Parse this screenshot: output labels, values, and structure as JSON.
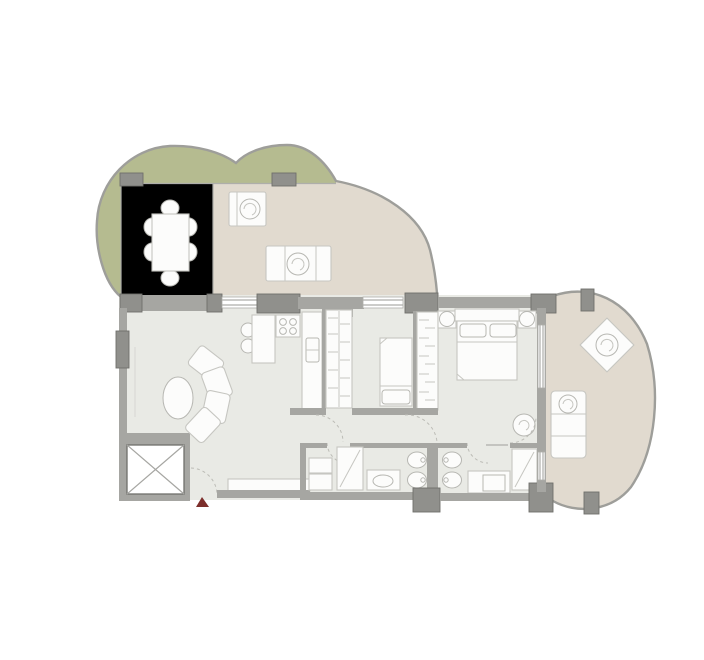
{
  "canvas": {
    "width": 704,
    "height": 660,
    "kind": "apartment-floor-plan"
  },
  "colors": {
    "background": "#ffffff",
    "floor": "#e9eae5",
    "dining_floor": "#ececе8",
    "terrace": "#e1dacf",
    "green": "#b5bb90",
    "wall": "#a6a6a2",
    "pillar": "#90908c",
    "pillar_stroke": "#6f6f6b",
    "outline": "#9e9e9a",
    "furniture": "#fcfcfb",
    "furniture_stroke": "#c6c6c1",
    "fixture_stroke": "#b7b7b2",
    "thin": "#d7d7d2",
    "glass": "#aeaeaa",
    "dash": "#bcbcb6",
    "hatch": "#c6c6c1",
    "red": "#7d2f2c"
  },
  "rooms": [
    {
      "name": "planted-border"
    },
    {
      "name": "dining-room"
    },
    {
      "name": "terrace"
    },
    {
      "name": "living-room"
    },
    {
      "name": "kitchen"
    },
    {
      "name": "hallway"
    },
    {
      "name": "bedroom-small"
    },
    {
      "name": "bedroom-master"
    },
    {
      "name": "bathroom-1"
    },
    {
      "name": "bathroom-2"
    },
    {
      "name": "balcony"
    },
    {
      "name": "elevator-shaft"
    }
  ],
  "furniture": [
    "dining-table-6-chairs",
    "terrace-armchair",
    "terrace-lounger",
    "breakfast-bar-2-stools",
    "curved-sofa",
    "oval-rug",
    "stove-4-burners",
    "kitchen-sink",
    "wardrobe-1",
    "wardrobe-2",
    "single-bed",
    "double-bed-2-nightstands",
    "plant",
    "washer-dryer",
    "shower-1",
    "sink-basin",
    "toilet-1",
    "bidet-1",
    "toilet-2",
    "bidet-2",
    "vanity-2",
    "shower-2",
    "balcony-diamond-chair",
    "balcony-lounger",
    "entrance-marker"
  ]
}
